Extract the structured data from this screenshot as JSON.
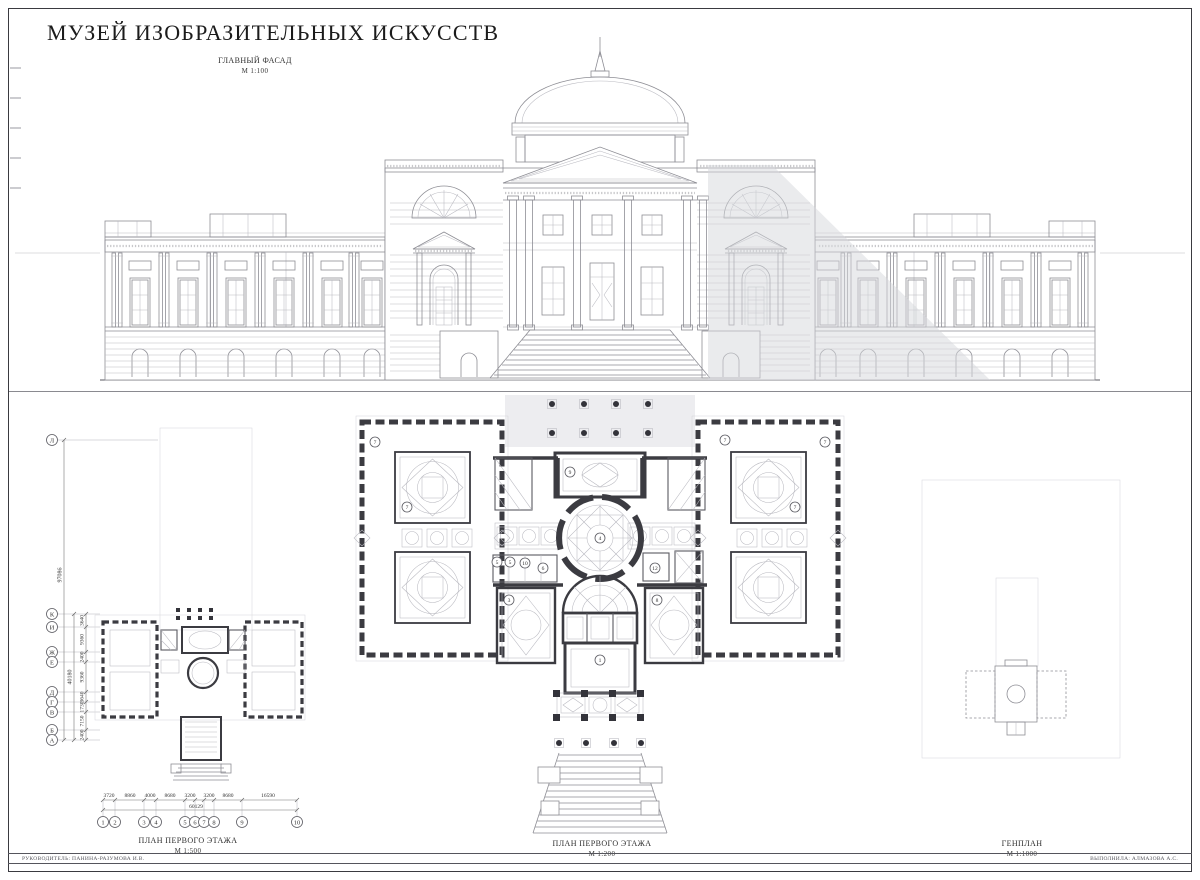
{
  "sheet": {
    "title": "МУЗЕЙ ИЗОБРАЗИТЕЛЬНЫХ ИСКУССТВ",
    "facade": {
      "label": "ГЛАВНЫЙ ФАСАД",
      "scale": "М 1:100"
    },
    "plan500": {
      "label": "ПЛАН ПЕРВОГО ЭТАЖА",
      "scale": "М 1:500"
    },
    "plan200": {
      "label": "ПЛАН ПЕРВОГО ЭТАЖА",
      "scale": "М 1:200"
    },
    "genplan": {
      "label": "ГЕНПЛАН",
      "scale": "М 1:1000"
    },
    "footer_left": "РУКОВОДИТЕЛЬ: ПАНИНА-РАЗУМОВА И.В.",
    "footer_right": "ВЫПОЛНИЛА: АЛМАЗОВА А.С."
  },
  "axes": {
    "letters": [
      "Л",
      "К",
      "И",
      "Ж",
      "Е",
      "Д",
      "Г",
      "В",
      "Б",
      "А"
    ],
    "numbers": [
      "1",
      "2",
      "3",
      "4",
      "5",
      "6",
      "7",
      "8",
      "9",
      "10"
    ],
    "v_dims": [
      "3640",
      "9360",
      "2400",
      "9360",
      "3640",
      "1730",
      "7150",
      "2400"
    ],
    "v_totals": [
      "97086",
      "40180"
    ],
    "h_dims": [
      "3720",
      "8860",
      "4000",
      "8680",
      "3200",
      "3200",
      "8680",
      "16590"
    ],
    "h_total": "60129"
  },
  "room_markers": [
    "7",
    "7",
    "7",
    "7",
    "7",
    "9",
    "4",
    "5",
    "5",
    "10",
    "6",
    "12",
    "3",
    "8",
    "1"
  ],
  "colors": {
    "wall": "#3b3b41",
    "line": "#8e8e95",
    "shadow": "#d6d7dc"
  }
}
